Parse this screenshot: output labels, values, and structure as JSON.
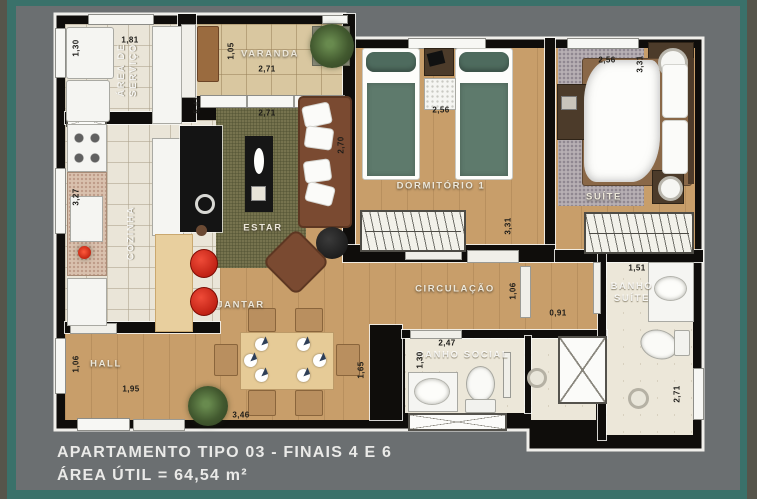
{
  "footer": {
    "line1": "APARTAMENTO TIPO 03 - FINAIS 4 E 6",
    "line2": "ÁREA ÚTIL = 64,54 m²"
  },
  "colors": {
    "frame_teal": "#3a716a",
    "background_gray": "#6b6f71",
    "edge_olive": "#56554b",
    "wall_black": "#0f0d0b",
    "wood_floor": "#c89e6a"
  },
  "rooms": {
    "area_servico": {
      "label_line1": "ÁREA DE",
      "label_line2": "SERVIÇO",
      "dim_width": "1,81",
      "dim_depth": "1,30"
    },
    "varanda": {
      "label": "VARANDA",
      "dim_width": "2,71",
      "dim_depth": "1,05"
    },
    "cozinha": {
      "label": "COZINHA",
      "dim_depth": "3,27"
    },
    "estar": {
      "label": "ESTAR",
      "dim_width": "2,71",
      "dim_height": "5,41",
      "dim_sofa": "2,70"
    },
    "jantar": {
      "label": "JANTAR",
      "dim_width": "3,46",
      "dim_height": "1,65"
    },
    "hall": {
      "label": "HALL",
      "dim_width": "1,95",
      "dim_height": "1,06"
    },
    "dormitorio1": {
      "label": "DORMITÓRIO 1",
      "dim_width": "2,56",
      "dim_height": "3,31"
    },
    "suite": {
      "label": "SUÍTE",
      "dim_width": "2,56",
      "dim_height": "3,31"
    },
    "circulacao": {
      "label": "CIRCULAÇÃO",
      "dim_width": "0,91",
      "dim_height": "1,06"
    },
    "banho_social": {
      "label": "BANHO SOCIAL",
      "dim_width": "2,47",
      "dim_height": "1,30"
    },
    "banho_suite": {
      "label_line1": "BANHO",
      "label_line2": "SUÍTE",
      "dim_width": "1,51",
      "dim_height": "2,71"
    }
  }
}
